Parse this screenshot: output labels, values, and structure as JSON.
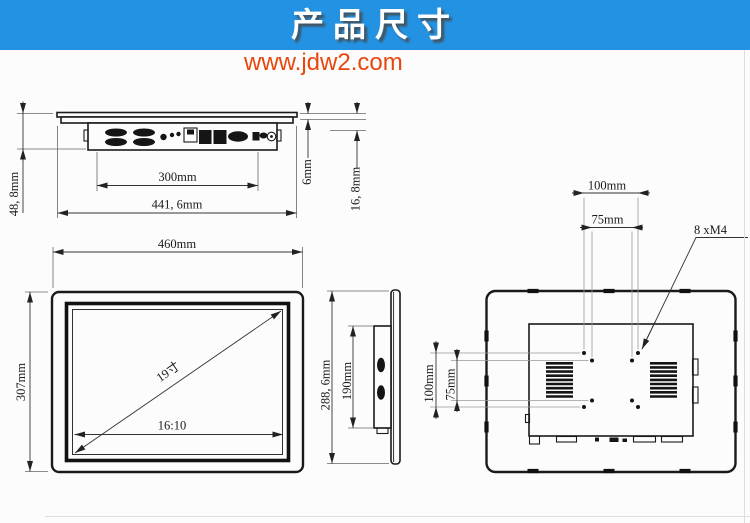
{
  "header": {
    "title": "产品尺寸",
    "banner_color": "#2492e2",
    "title_color": "#ffffff",
    "url": "www.jdw2.com",
    "url_color": "#e8470e"
  },
  "labels": {
    "top": {
      "inner_width": "300mm",
      "overall_width": "441, 6mm",
      "overall_depth": "48, 8mm",
      "bezel_thickness": "6mm",
      "front_depth": "16, 8mm"
    },
    "front": {
      "width": "460mm",
      "height": "307mm",
      "diagonal": "19寸",
      "aspect_ratio": "16:10"
    },
    "side": {
      "overall_height": "288, 6mm",
      "body_height": "190mm"
    },
    "back": {
      "vesa_width_100": "100mm",
      "vesa_width_75": "75mm",
      "vesa_height_100": "100mm",
      "vesa_height_75": "75mm",
      "screw_spec": "8 xM4"
    }
  }
}
